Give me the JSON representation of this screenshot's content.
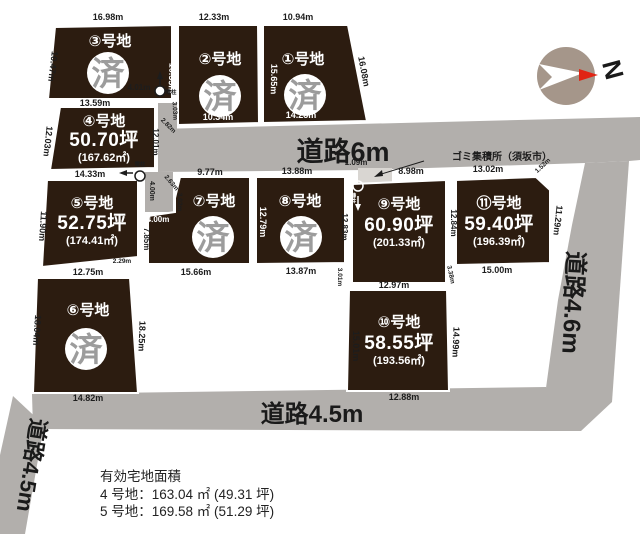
{
  "map": {
    "roads": {
      "road_6m": "道路6m",
      "road_45_bottom": "道路4.5m",
      "road_46_right": "道路4.6m",
      "road_45_left": "道路4.5m"
    },
    "garbage_station": "ゴミ集積所（須坂市）",
    "pole_label": "電柱",
    "compass_n": "N",
    "lots": [
      {
        "label": "①号地",
        "sold": "済",
        "top": "10.94m",
        "left": "15.65m",
        "right": "16.08m",
        "bottom": "14.23m"
      },
      {
        "label": "②号地",
        "sold": "済",
        "top": "12.33m",
        "left": "10.55m",
        "bottom": "10.34m"
      },
      {
        "label": "③号地",
        "sold": "済",
        "top": "16.98m",
        "left": "10.47m",
        "bottom": "13.59m"
      },
      {
        "label": "④号地",
        "tsubo": "50.70坪",
        "m2": "(167.62㎡)",
        "left": "12.03m",
        "right": "12.01m",
        "bottom": "14.33m"
      },
      {
        "label": "⑤号地",
        "tsubo": "52.75坪",
        "m2": "(174.41㎡)",
        "left": "11.90m",
        "right": "7.85m",
        "bottom": "12.75m",
        "small": "2.29m"
      },
      {
        "label": "⑥号地",
        "sold": "済",
        "left": "18.04m",
        "right": "18.25m",
        "bottom": "14.82m"
      },
      {
        "label": "⑦号地",
        "sold": "済",
        "top": "9.77m",
        "bottom": "15.66m",
        "notch_w": "4.00m",
        "notch_h": "4.00m",
        "corner": "2.63m",
        "edge": "3.02m"
      },
      {
        "label": "⑧号地",
        "sold": "済",
        "top": "13.88m",
        "left": "12.79m",
        "right": "12.83m",
        "bottom": "13.87m",
        "small": "3.01m"
      },
      {
        "label": "⑨号地",
        "tsubo": "60.90坪",
        "m2": "(201.33㎡)",
        "top_left": "1.09m",
        "top": "8.98m",
        "bottom": "12.97m",
        "small": "3.38m"
      },
      {
        "label": "⑩号地",
        "tsubo": "58.55坪",
        "m2": "(193.56㎡)",
        "left": "15.01m",
        "right": "14.99m",
        "bottom": "12.88m"
      },
      {
        "label": "⑪号地",
        "tsubo": "59.40坪",
        "m2": "(196.39㎡)",
        "top": "13.02m",
        "left": "12.84m",
        "right": "11.29m",
        "bottom": "15.00m",
        "corner": "1.52m"
      }
    ],
    "road_dims": {
      "pole_top": "4.01m",
      "vert": "12.01m",
      "top_edge": "3.03m",
      "diag": "2.82m"
    }
  },
  "notes": {
    "title": "有効宅地面積",
    "line1": "4 号地：163.04 ㎡ (49.31 坪)",
    "line2": "5 号地：169.58 ㎡ (51.29 坪)"
  },
  "colors": {
    "lot": "#2c1c10",
    "road": "#b2afac",
    "garbage_box": "#d9d6d2",
    "compass": "#a5968a",
    "compass_tip": "#e02414"
  }
}
